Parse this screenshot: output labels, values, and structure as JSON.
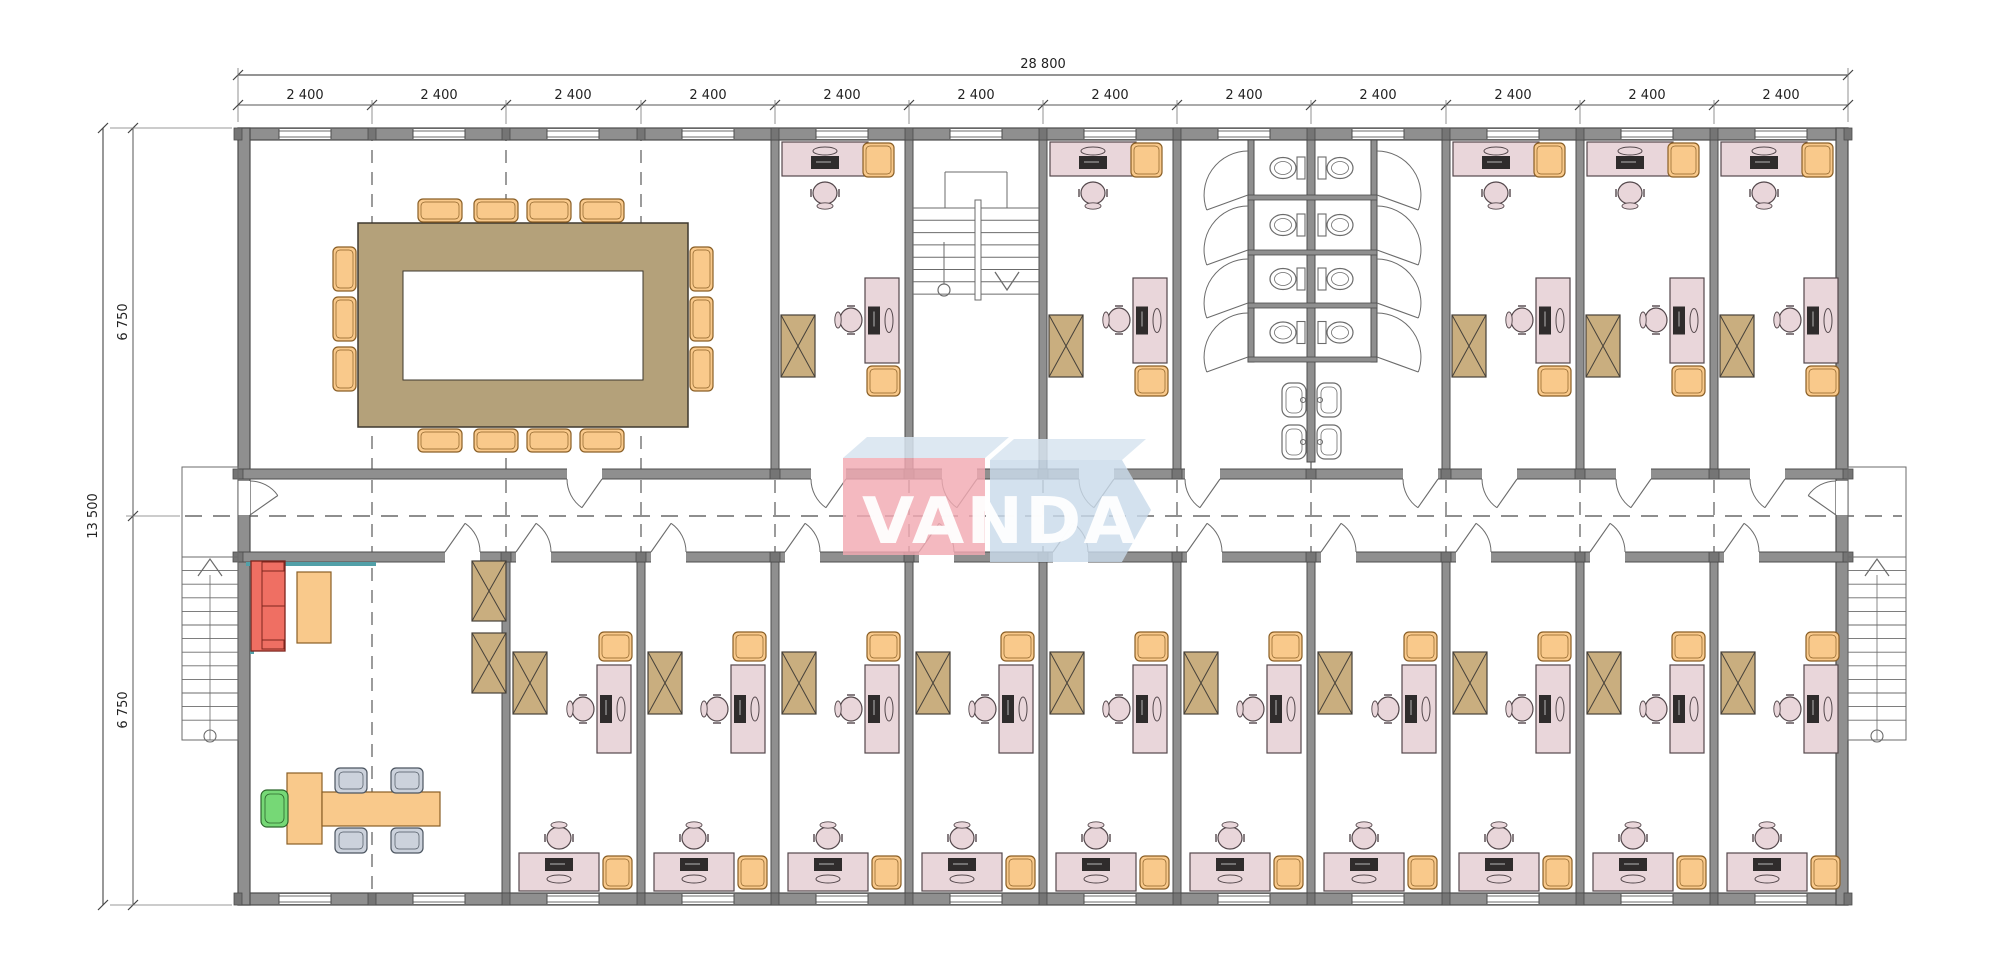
{
  "watermark": {
    "text": "VANDA"
  },
  "dimensions": {
    "top_total": "28 800",
    "top_segments": [
      "2 400",
      "2 400",
      "2 400",
      "2 400",
      "2 400",
      "2 400",
      "2 400",
      "2 400",
      "2 400",
      "2 400",
      "2 400",
      "2 400"
    ],
    "left_total": "13 500",
    "left_segments": [
      "6 750",
      "6 750"
    ]
  },
  "colors": {
    "wall": "#8f8f8f",
    "wall_edge": "#4c4c4c",
    "column": "#757575",
    "line": "#6b6b6b",
    "dash": "#4a4a4a",
    "desk": "#e9d6da",
    "desk_edge": "#54484c",
    "chair_visitor": "#f9c98b",
    "chair_visitor_edge": "#8a5f26",
    "cabinet": "#c9ae7f",
    "cabinet_edge": "#46413a",
    "conference_table": "#b4a17a",
    "conference_table_edge": "#3e382e",
    "sofa": "#ef6f63",
    "sofa_edge": "#7c241c",
    "coffee_table": "#f9c98b",
    "chair_meeting": "#ccd2dc",
    "chair_meeting_edge": "#4c5560",
    "chair_green": "#76d876",
    "chair_green_edge": "#2c662c",
    "monitor": "#2f2c2c",
    "teal_accent": "#52a0a8",
    "logo_front_red": "#f2a9b2",
    "logo_front_blue": "#c9daea",
    "logo_top": "#d7e4f0",
    "dim_text": "#222222"
  }
}
